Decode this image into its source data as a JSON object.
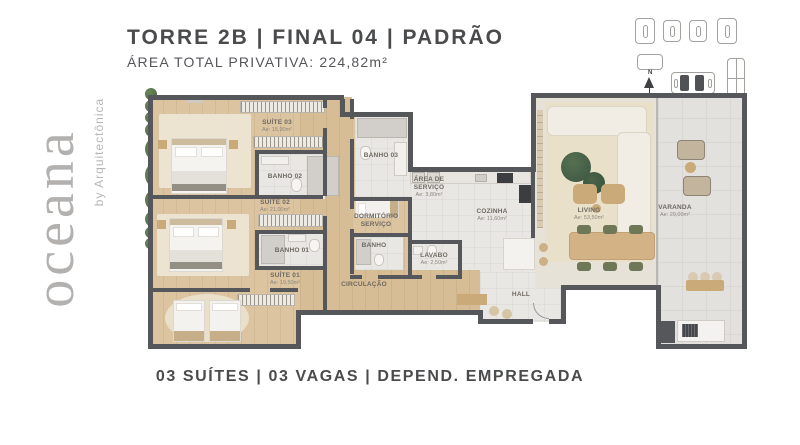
{
  "header": {
    "title": "TORRE 2B | FINAL 04 | PADRÃO",
    "subtitle": "ÁREA TOTAL PRIVATIVA: 224,82m²"
  },
  "logo": {
    "brand": "oceana",
    "byline": "by Arquitectônica"
  },
  "keyplan": {
    "north_label": "N"
  },
  "footer": {
    "summary": "03 SUÍTES | 03 VAGAS | DEPEND. EMPREGADA"
  },
  "colors": {
    "wall": "#56575b",
    "wood_floor": "#dbc49f",
    "tile_floor": "#e9e7e3",
    "accent_green": "#55724a",
    "sofa_cream": "#f1ede4",
    "logo_gray": "#b3b1af"
  },
  "rooms": [
    {
      "id": "suite03",
      "name": "SUÍTE 03",
      "area": "Ae: 15,90m²",
      "x": 132,
      "y": 38
    },
    {
      "id": "banho02",
      "name": "BANHO 02",
      "area": null,
      "x": 140,
      "y": 89
    },
    {
      "id": "banho03",
      "name": "BANHO 03",
      "area": null,
      "x": 236,
      "y": 68
    },
    {
      "id": "suite02",
      "name": "SUÍTE 02",
      "area": "Ae: 21,00m²",
      "x": 130,
      "y": 118
    },
    {
      "id": "area-servico",
      "name": "ÁREA DE SERVIÇO",
      "area": "Ae: 3,80m²",
      "x": 284,
      "y": 99,
      "w": 34
    },
    {
      "id": "dormitorio-servico",
      "name": "DORMITÓRIO SERVIÇO",
      "area": null,
      "x": 231,
      "y": 133,
      "w": 44
    },
    {
      "id": "banho-servico",
      "name": "BANHO",
      "area": null,
      "x": 229,
      "y": 158
    },
    {
      "id": "lavabo",
      "name": "LAVABO",
      "area": "Ae: 2,50m²",
      "x": 289,
      "y": 171
    },
    {
      "id": "cozinha",
      "name": "COZINHA",
      "area": "Ae: 11,60m²",
      "x": 347,
      "y": 127
    },
    {
      "id": "circulacao",
      "name": "CIRCULAÇÃO",
      "area": null,
      "x": 219,
      "y": 197
    },
    {
      "id": "banho01",
      "name": "BANHO 01",
      "area": null,
      "x": 147,
      "y": 163
    },
    {
      "id": "suite01",
      "name": "SUÍTE 01",
      "area": "Ae: 19,50m²",
      "x": 140,
      "y": 191
    },
    {
      "id": "hall",
      "name": "HALL",
      "area": null,
      "x": 376,
      "y": 207
    },
    {
      "id": "living",
      "name": "LIVING",
      "area": "Ae: 53,50m²",
      "x": 444,
      "y": 126
    },
    {
      "id": "varanda",
      "name": "VARANDA",
      "area": "Ae: 29,00m²",
      "x": 530,
      "y": 123
    }
  ]
}
